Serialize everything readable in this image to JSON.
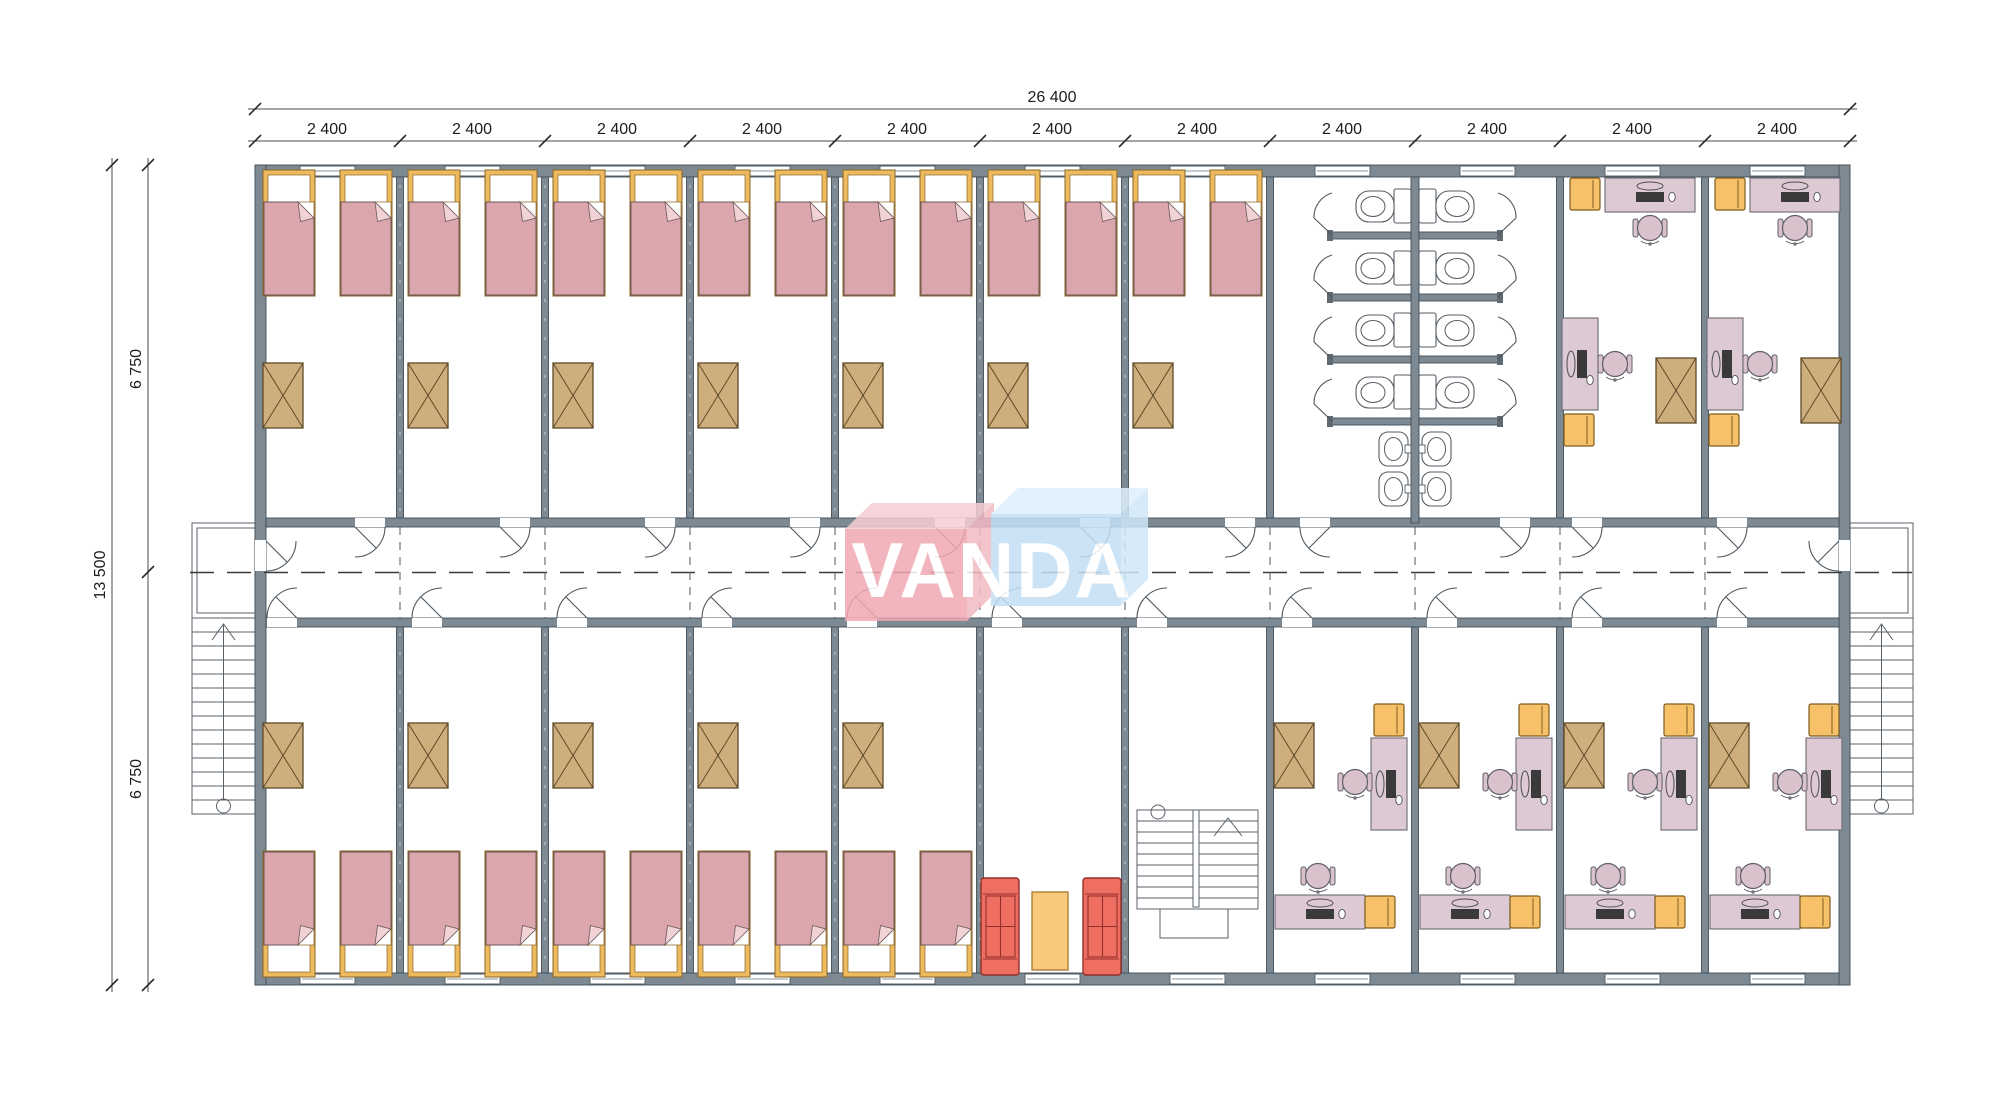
{
  "watermark": {
    "text": "VANDA",
    "pink_box_color": "#f0a8b2",
    "pink_box_top_color": "#f7cdd4",
    "blue_box_color": "#c4dff5",
    "blue_box_top_color": "#def0fc",
    "text_color": "#ffffff"
  },
  "dimensions": {
    "total_width": "26 400",
    "bay": "2 400",
    "bay_count": 11,
    "total_depth": "13 500",
    "half_depth": "6 750"
  },
  "plan": {
    "building": "single-storey modular dormitory / office block floor plan",
    "rooms": {
      "bedrooms_top_row": 7,
      "bedrooms_bottom_row": 5,
      "offices_top_row": 2,
      "offices_bottom_row": 4,
      "toilet_stalls": 8,
      "wash_basins": 4,
      "lounge_rooms": 1,
      "internal_stairwells": 1,
      "external_stairs": 2
    },
    "furniture_per_bedroom": {
      "beds": 2,
      "wardrobes": 1
    },
    "colors": {
      "wall": "#7d8a93",
      "bed_frame": "#edba5e",
      "bed_blanket": "#dba7ac",
      "bed_fold": "#f1d3d6",
      "wardrobe": "#cfae7e",
      "desk": "#dcc9d3",
      "chair": "#d9c2cc",
      "cabinet": "#f6c169",
      "sofa": "#ef6e62",
      "coffee_table": "#f8c87d"
    }
  }
}
